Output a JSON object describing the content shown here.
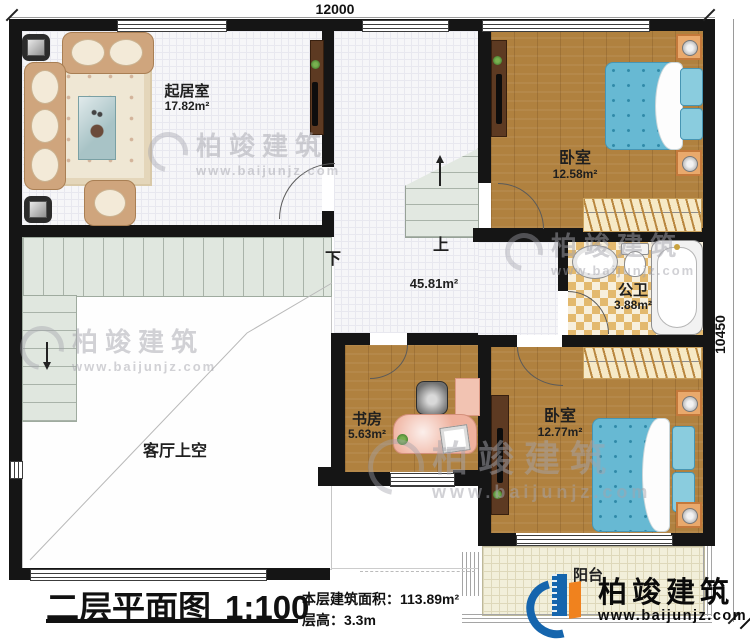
{
  "dimensions": {
    "width_mm": "12000",
    "height_mm": "10450"
  },
  "rooms": {
    "living": {
      "name": "起居室",
      "area": "17.82m²"
    },
    "bedroom1": {
      "name": "卧室",
      "area": "12.58m²"
    },
    "bath": {
      "name": "公卫",
      "area": "3.88m²"
    },
    "study": {
      "name": "书房",
      "area": "5.63m²"
    },
    "bedroom2": {
      "name": "卧室",
      "area": "12.77m²"
    },
    "hall": {
      "area": "45.81m²"
    },
    "void": {
      "name": "客厅上空"
    },
    "balcony": {
      "name": "阳台"
    }
  },
  "stairs": {
    "up": "上",
    "down": "下",
    "up_arrow": "↑",
    "down_arrow": "↓"
  },
  "title_block": {
    "title": "二层平面图",
    "scale": "1:100",
    "area_label": "本层建筑面积：",
    "area_value": "113.89m²",
    "height_label": "层高：",
    "height_value": "3.3m"
  },
  "brand": {
    "name": "柏竣建筑",
    "url": "www.baijunjz.com"
  },
  "colors": {
    "wall": "#151515",
    "wood": "#b0813f",
    "bed": "#67b9d3",
    "logo_blue": "#1565ad",
    "logo_orange": "#f0821e"
  }
}
